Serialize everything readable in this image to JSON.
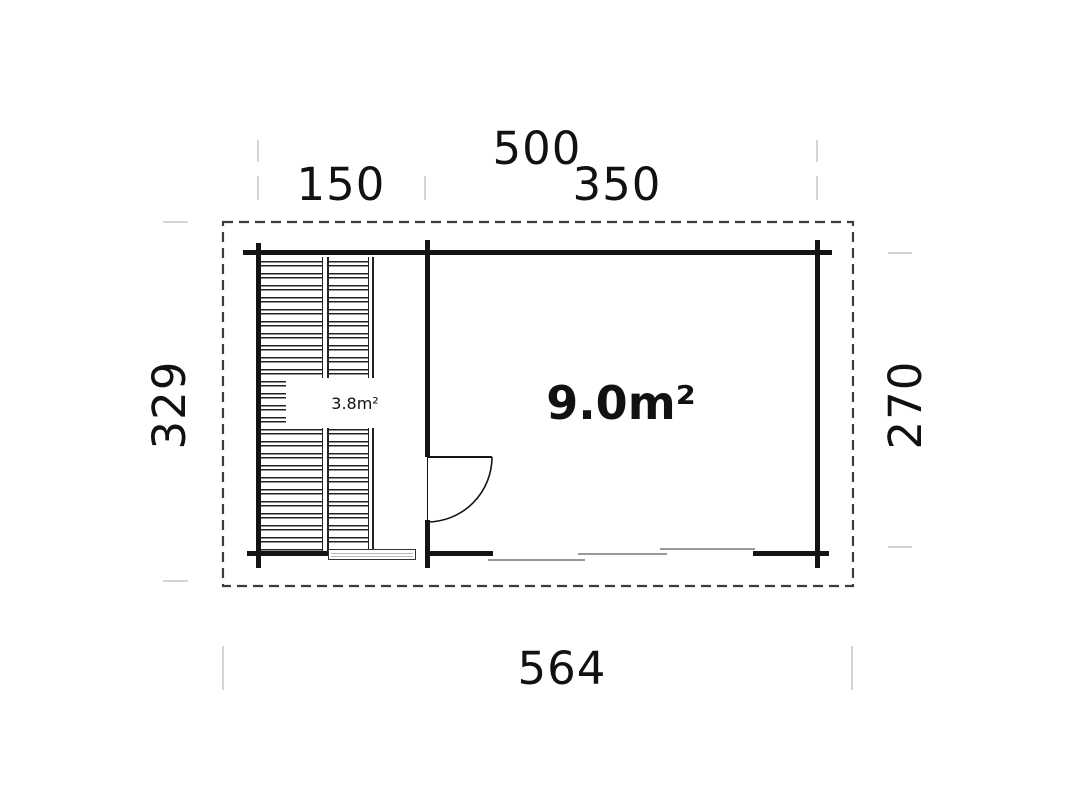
{
  "plan": {
    "top_dimensions": {
      "overall": "500",
      "left_section": "150",
      "right_section": "350"
    },
    "side_dimensions": {
      "left_overall": "329",
      "right_inner": "270"
    },
    "bottom_dimension": "564",
    "rooms": [
      {
        "id": "terrace",
        "area": "3.8m²"
      },
      {
        "id": "main-room",
        "area": "9.0m²"
      }
    ]
  },
  "colors": {
    "wall": "#141414",
    "dashed_boundary": "#3c3c3c",
    "tick": "#d5d5d5",
    "sliding_door_line": "#999999",
    "background": "#ffffff"
  }
}
